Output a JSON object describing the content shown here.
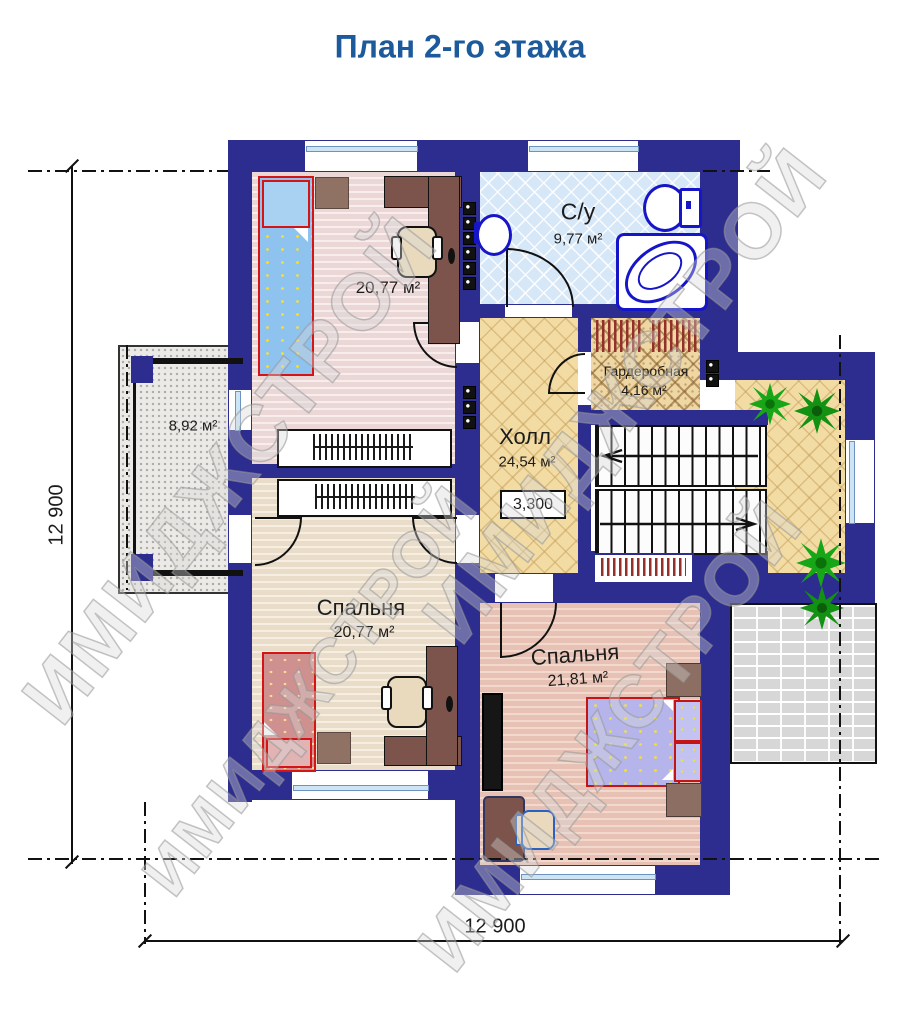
{
  "title": "План 2-го этажа",
  "watermark_text": "ИМИДЖСТРОЙ",
  "rooms": {
    "bathroom": {
      "name": "С/у",
      "area": "9,77 м²"
    },
    "study": {
      "area": "20,77 м²"
    },
    "wardrobe": {
      "name": "Гардеробная",
      "area": "4,16 м²"
    },
    "hall": {
      "name": "Холл",
      "area": "24,54 м²",
      "elevation_mark": "3,300"
    },
    "balcony": {
      "area": "8,92 м²"
    },
    "bedroom_left": {
      "name": "Спальня",
      "area": "20,77 м²"
    },
    "bedroom_right": {
      "name": "Спальня",
      "area": "21,81 м²"
    }
  },
  "dimensions": {
    "bottom": "12 900",
    "left": "12 900"
  },
  "colors": {
    "wall": "#2d2d8f",
    "title": "#1d5a9b",
    "fixture": "#1616c8",
    "bed_accent": "#d51515"
  }
}
